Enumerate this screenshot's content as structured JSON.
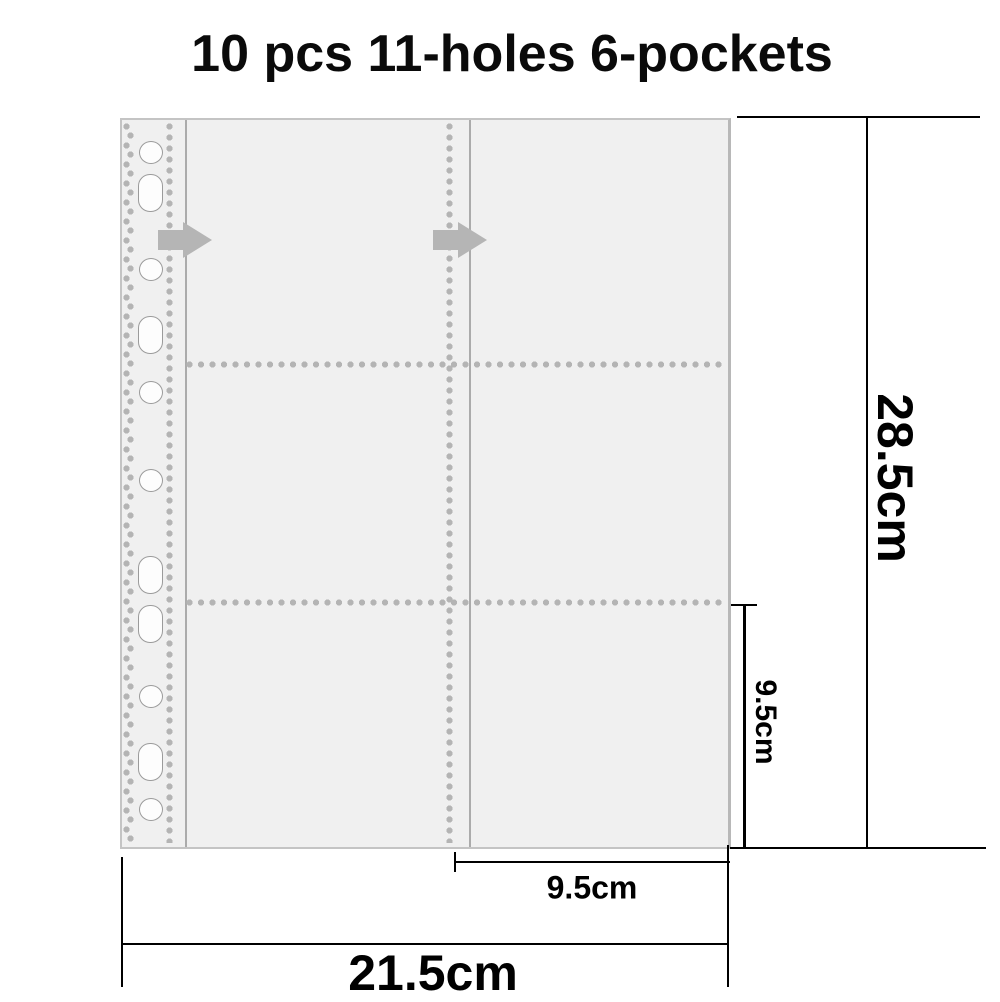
{
  "title": "10 pcs 11-holes 6-pockets",
  "dimensions": {
    "sheet_height": "28.5cm",
    "sheet_width": "21.5cm",
    "pocket_height": "9.5cm",
    "pocket_width": "9.5cm"
  },
  "icons": {
    "pocket_opening_arrow": "arrow-right-icon"
  },
  "colors": {
    "sheet_fill": "#f0f0f0",
    "sheet_border": "#c4c4c4",
    "stitch_dot": "#b4b4b4",
    "seam_line": "#ababab",
    "arrow": "#b5b5b5",
    "hole_fill": "#fdfdfd",
    "hole_border": "#9b9b9b",
    "dimension": "#000000"
  }
}
